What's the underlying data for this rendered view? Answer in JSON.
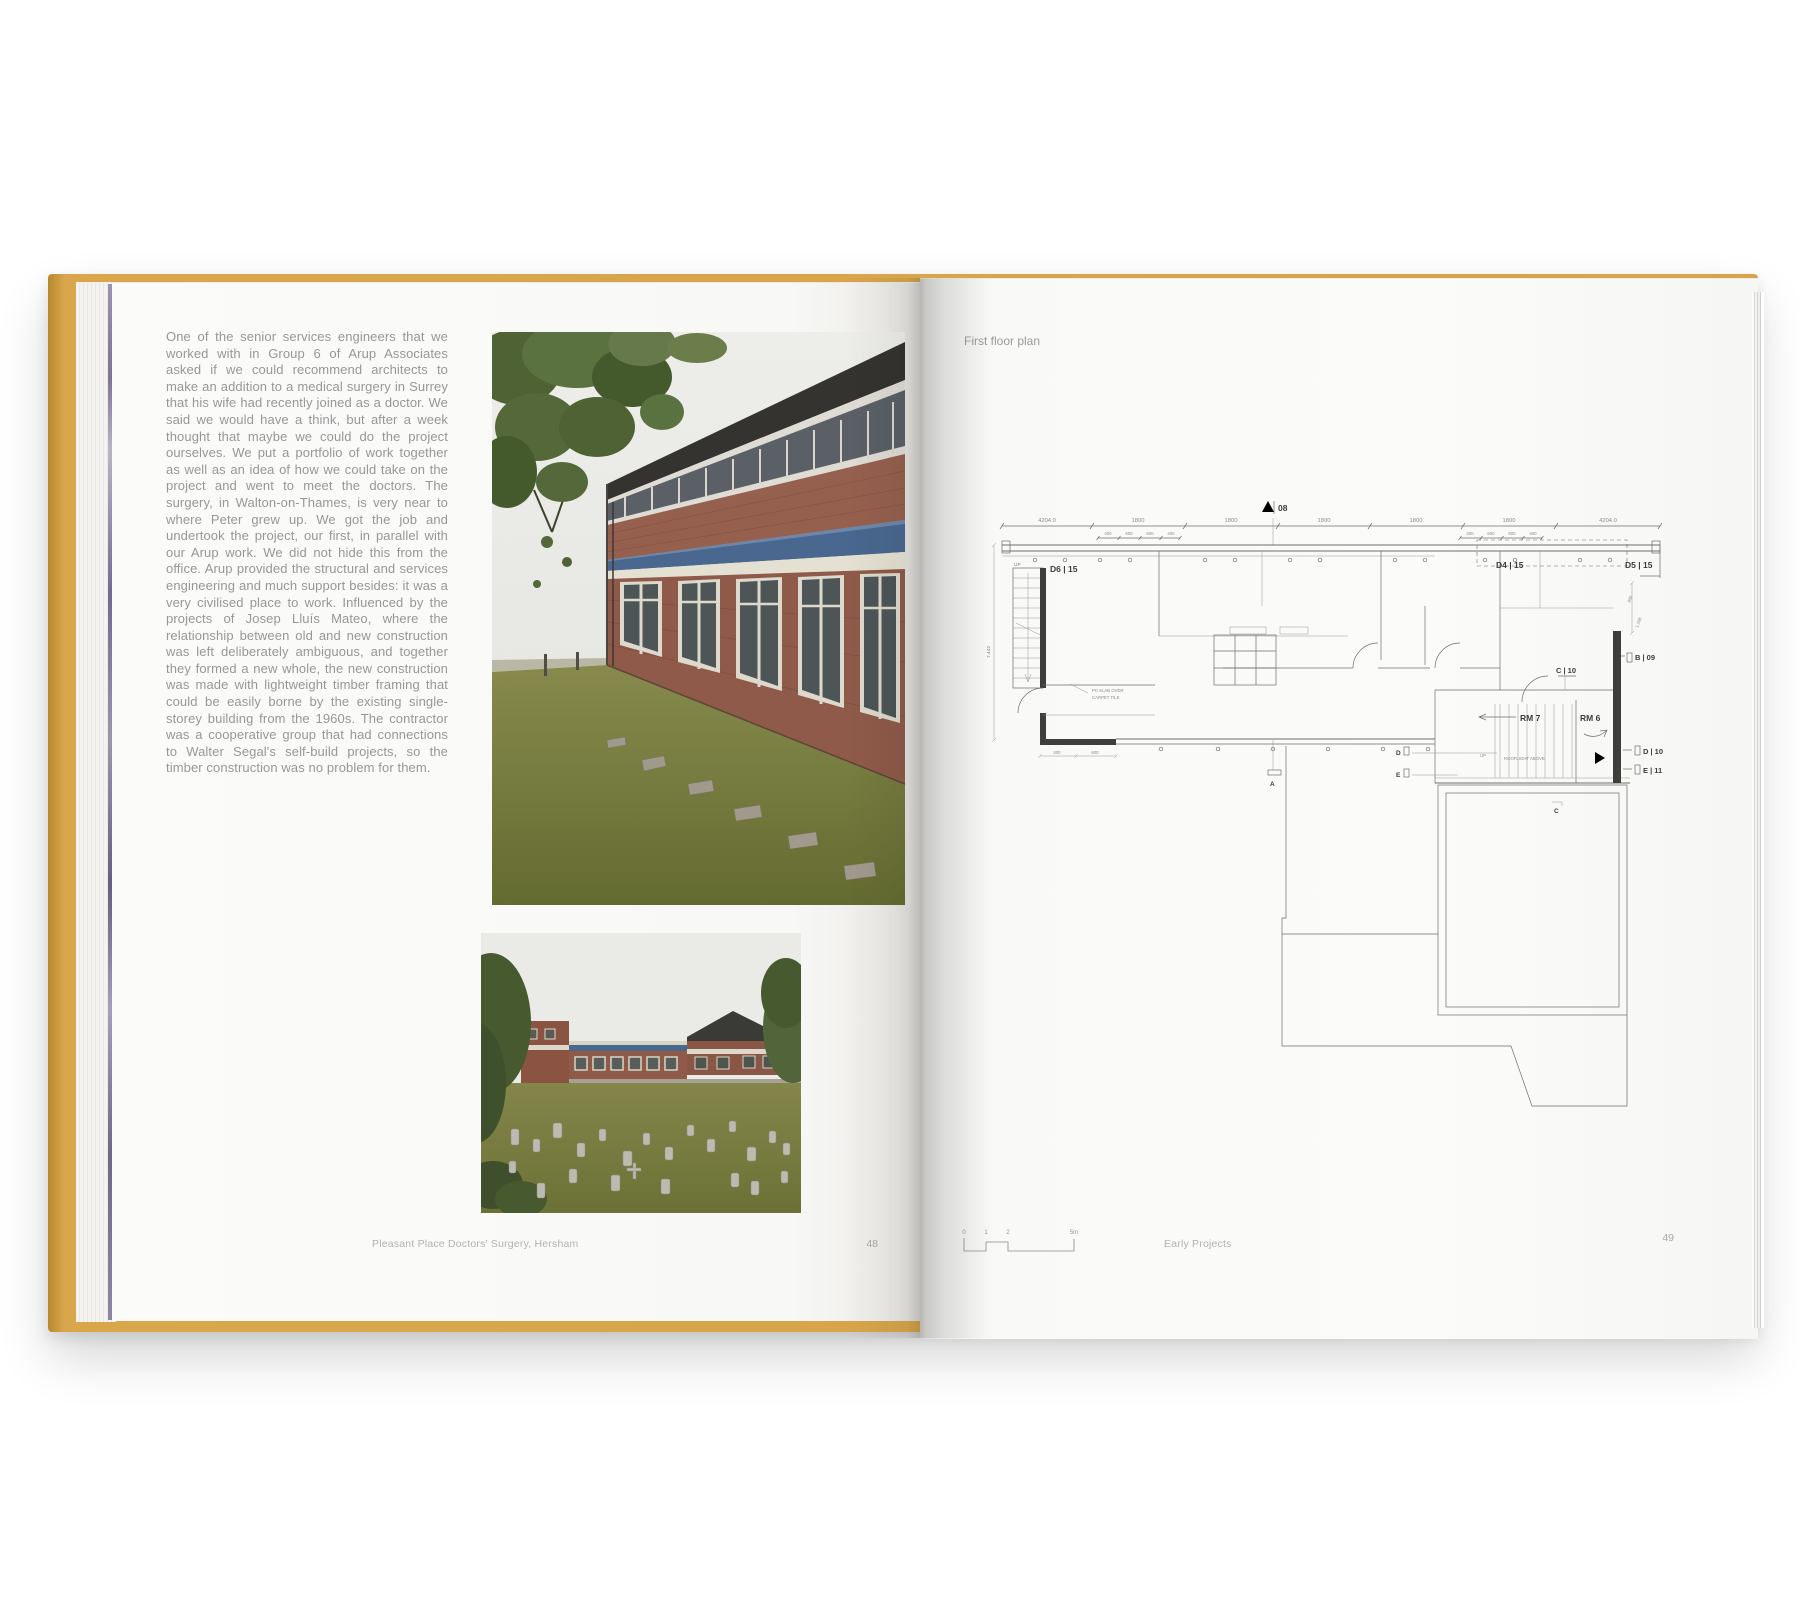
{
  "book": {
    "cover_color": "#d9a64c",
    "left_page": {
      "body_text": "One of the senior services engineers that we worked with in Group 6 of Arup Associates asked if we could recommend architects to make an addition to a medical surgery in Surrey that his wife had recently joined as a doctor. We said we would have a think, but after a week thought that maybe we could do the project ourselves. We put a portfolio of work together as well as an idea of how we could take on the project and went to meet the doctors. The surgery, in Walton-on-Thames, is very near to where Peter grew up. We got the job and undertook the project, our first, in parallel with our Arup work. We did not hide this from the office. Arup provided the structural and services engineering and much support besides: it was a very civilised place to work. Influenced by the projects of Josep Lluís Mateo, where the relationship between old and new construction was left deliberately ambiguous, and together they formed a new whole, the new construction was made with lightweight timber framing that could be easily borne by the existing single-storey building from the 1960s. The contractor was a cooperative group that had connections to Walter Segal's self-build projects, so the timber construction was no problem for them.",
      "footer_caption": "Pleasant Place Doctors' Surgery, Hersham",
      "page_number": "48"
    },
    "right_page": {
      "header": "First floor plan",
      "footer_caption": "Early Projects",
      "page_number": "49",
      "scale_bar": {
        "labels": [
          "0",
          "1",
          "2",
          "5m"
        ]
      },
      "plan": {
        "section_top": "08",
        "tags": [
          "D6 | 15",
          "D4 | 15",
          "D5 | 15",
          "B | 09",
          "C | 10",
          "D | 10",
          "E | 11"
        ],
        "rooms": [
          "RM 7",
          "RM 6"
        ],
        "notes": {
          "up1": "UP",
          "up2": "UP",
          "rooflight": "ROOFLIGHT ABOVE",
          "floor1": "PC SLAB OVER",
          "floor2": "CARPET TILE"
        },
        "markers": {
          "a": "A",
          "c": "C",
          "d": "D",
          "e": "E"
        },
        "dims": {
          "top": [
            "4204.0",
            "1800",
            "1800",
            "1800",
            "1800",
            "1800",
            "4204.0"
          ],
          "sub_left": [
            "400",
            "600",
            "600",
            "400"
          ],
          "sub_right": [
            "400",
            "600",
            "600",
            "400"
          ],
          "left_v": "7.442",
          "right_v1": "400",
          "right_v2": "1.206",
          "bottom": [
            "400",
            "600"
          ]
        }
      }
    }
  }
}
